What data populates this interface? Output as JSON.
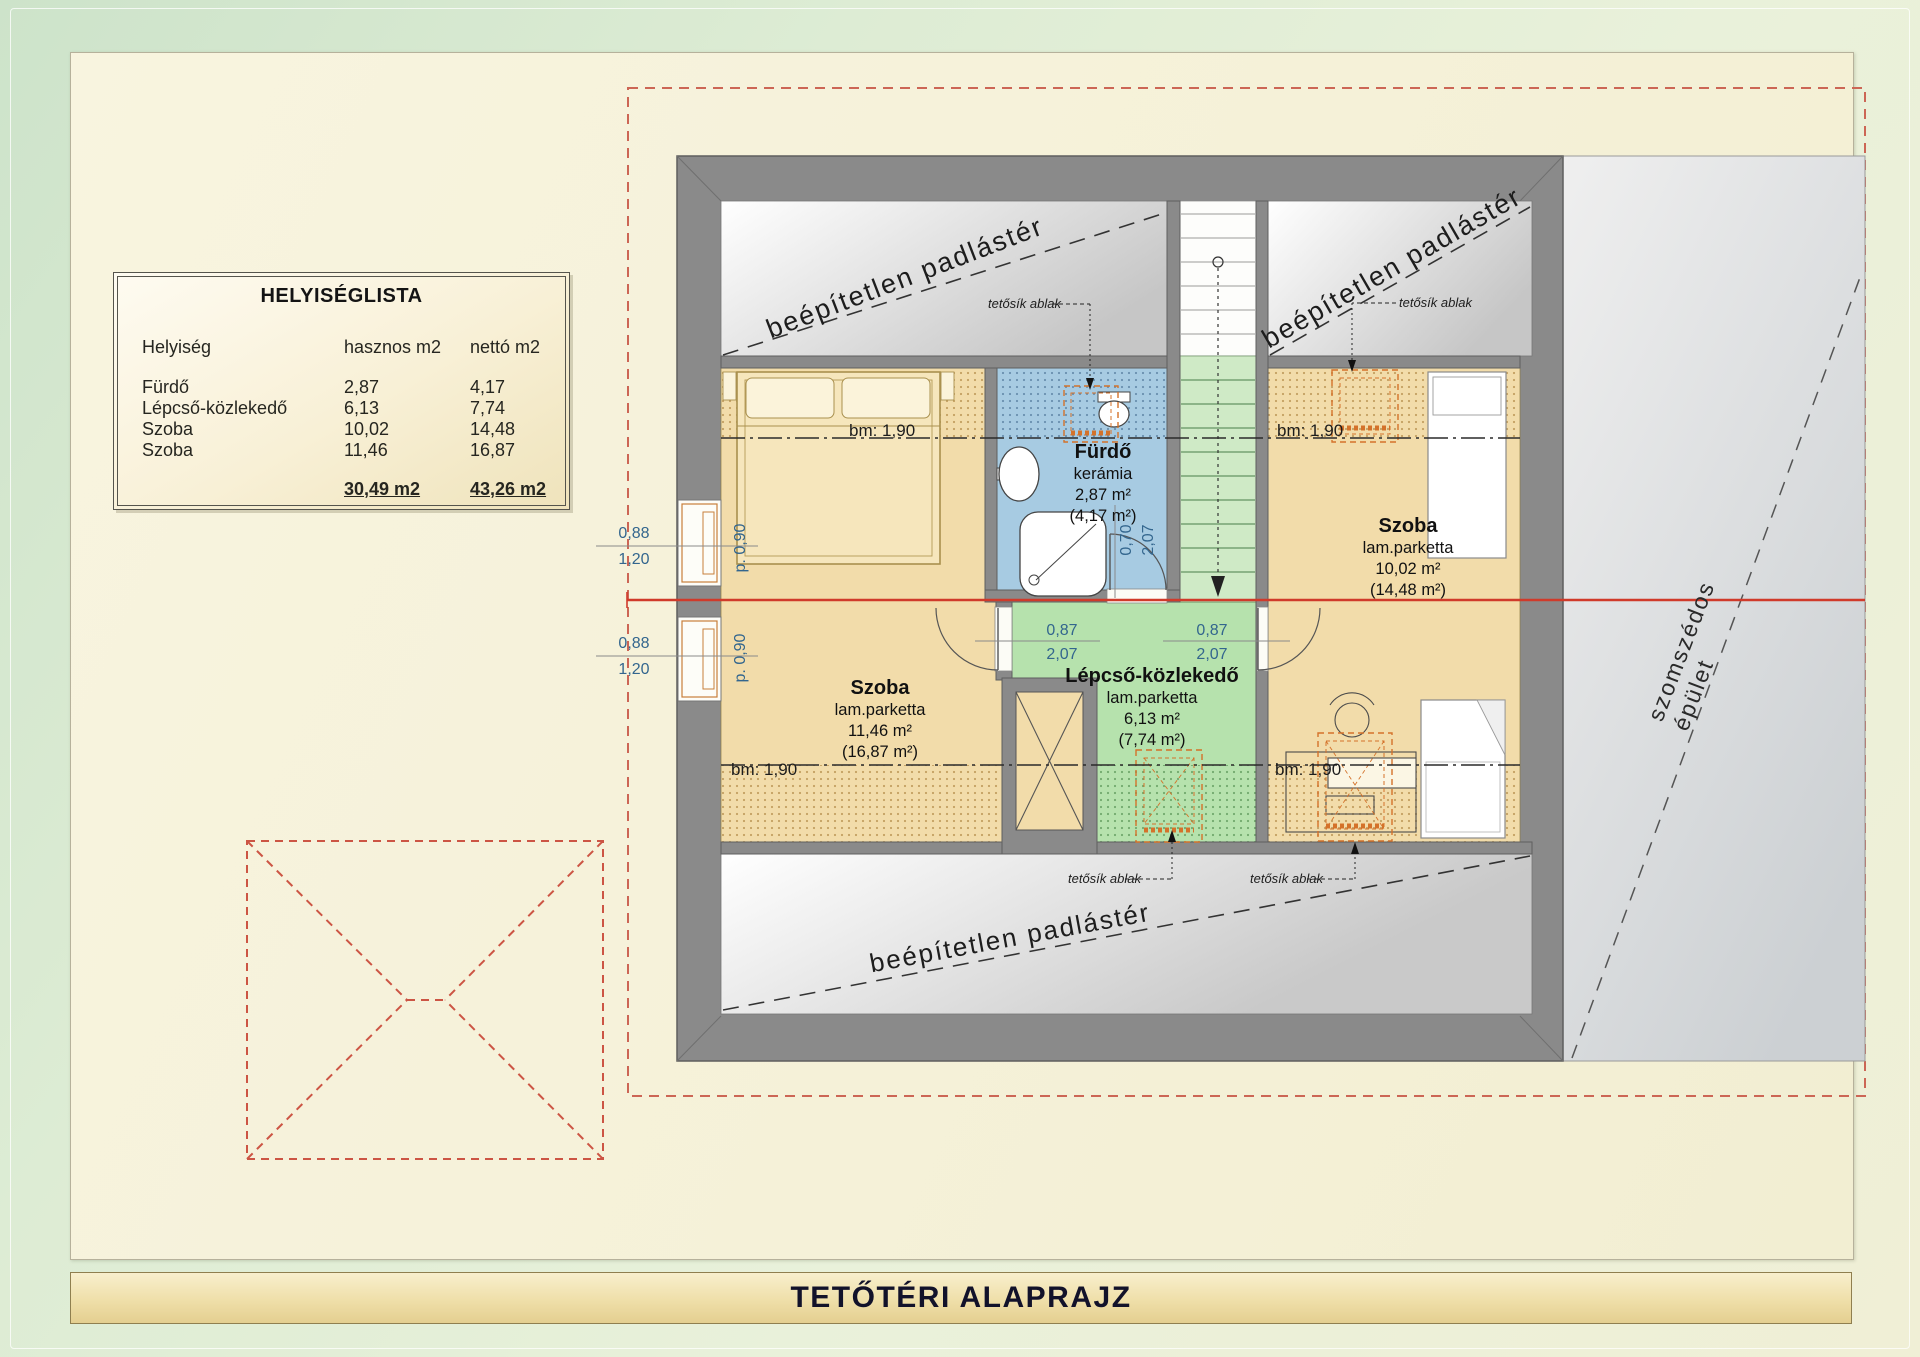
{
  "title_bar": {
    "text": "TETŐTÉRI ALAPRAJZ"
  },
  "room_list": {
    "title": "HELYISÉGLISTA",
    "columns": [
      "Helyiség",
      "hasznos m2",
      "nettó m2"
    ],
    "rows": [
      {
        "name": "Fürdő",
        "hasznos": "2,87",
        "netto": "4,17"
      },
      {
        "name": "Lépcső-közlekedő",
        "hasznos": "6,13",
        "netto": "7,74"
      },
      {
        "name": "Szoba",
        "hasznos": "10,02",
        "netto": "14,48"
      },
      {
        "name": "Szoba",
        "hasznos": "11,46",
        "netto": "16,87"
      }
    ],
    "total": {
      "hasznos": "30,49 m2",
      "netto": "43,26 m2"
    }
  },
  "rooms": {
    "bathroom": {
      "name": "Fürdő",
      "finish": "kerámia",
      "area": "2,87 m²",
      "area_net": "(4,17 m²)"
    },
    "hall": {
      "name": "Lépcső-közlekedő",
      "finish": "lam.parketta",
      "area": "6,13 m²",
      "area_net": "(7,74 m²)"
    },
    "bedroom_left": {
      "name": "Szoba",
      "finish": "lam.parketta",
      "area": "11,46 m²",
      "area_net": "(16,87 m²)"
    },
    "bedroom_right": {
      "name": "Szoba",
      "finish": "lam.parketta",
      "area": "10,02 m²",
      "area_net": "(14,48 m²)"
    }
  },
  "annotations": {
    "attic_label": "beépítetlen padlástér",
    "neighbor_label": "szomszédos épület",
    "roof_window_label": "tetősík ablak",
    "headroom_label": "bm: 1,90",
    "door_width": "0,87",
    "door_height": "2,07",
    "bath_door_width": "0,70",
    "bath_door_height": "2,07",
    "window_width": "0,88",
    "window_height": "1,20",
    "window_parapet": "p. 0,90"
  },
  "colors": {
    "accent_red": "#cc4433",
    "section_red": "#d03a2a",
    "wall_gray": "#8a8a8a",
    "room_tan": "#f2dcaa",
    "bath_blue": "#a7cbe2",
    "hall_green": "#b6e2ad",
    "roof_window_orange": "#d4722a",
    "dim_blue": "#33668e"
  }
}
